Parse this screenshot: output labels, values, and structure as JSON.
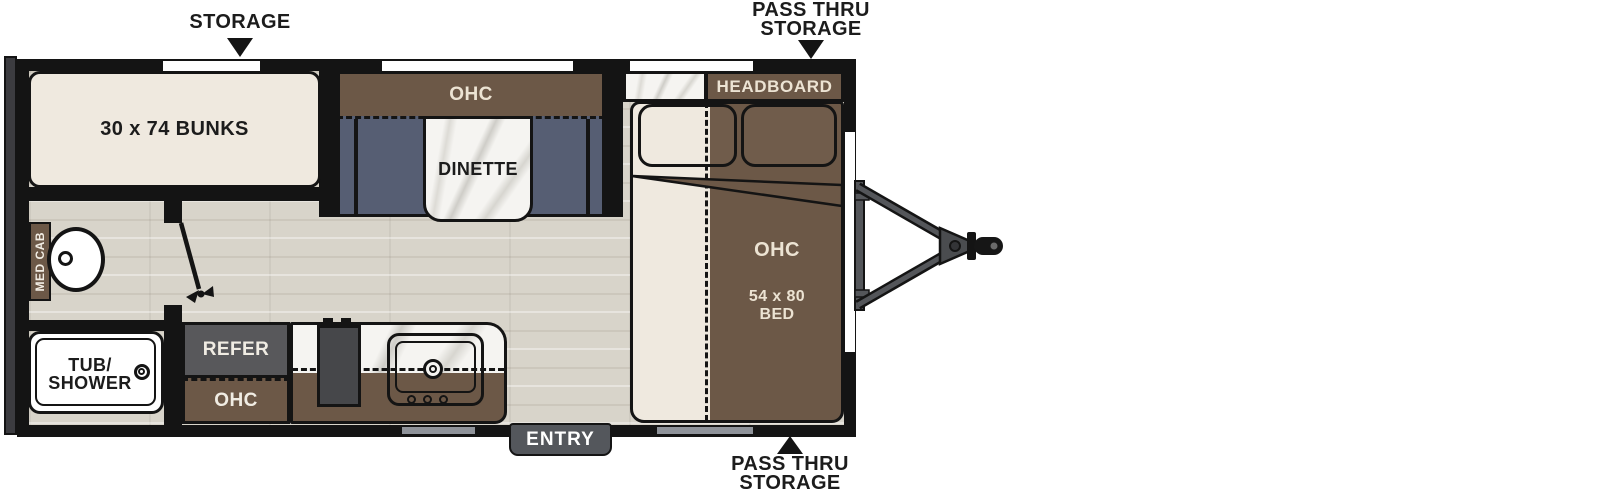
{
  "colors": {
    "wall": "#141414",
    "cabinet_brown": "#6c5847",
    "bench_slate": "#565e73",
    "mattress_cream": "#efe9df",
    "floor_wood": "#d8d4ca",
    "counter_marble": "#f5f4f1",
    "refer_gray": "#58585b",
    "entry_gray": "#54575c",
    "door_strip_gray": "#8f939a",
    "dark_label_text": "#1c1c1c",
    "light_label_text": "#ece3d3"
  },
  "callouts": {
    "storage_top": "STORAGE",
    "pass_thru_top_line1": "PASS THRU",
    "pass_thru_top_line2": "STORAGE",
    "pass_thru_bottom_line1": "PASS THRU",
    "pass_thru_bottom_line2": "STORAGE"
  },
  "rooms": {
    "bunks_label": "30 x 74 BUNKS",
    "dinette_ohc_label": "OHC",
    "dinette_label": "DINETTE",
    "headboard_label": "HEADBOARD",
    "bed_ohc_label": "OHC",
    "bed_size_line1": "54 x 80",
    "bed_size_line2": "BED",
    "med_cab_label": "MED CAB",
    "tub_line1": "TUB/",
    "tub_line2": "SHOWER",
    "refer_label": "REFER",
    "kitchen_ohc_label": "OHC",
    "entry_label": "ENTRY"
  }
}
